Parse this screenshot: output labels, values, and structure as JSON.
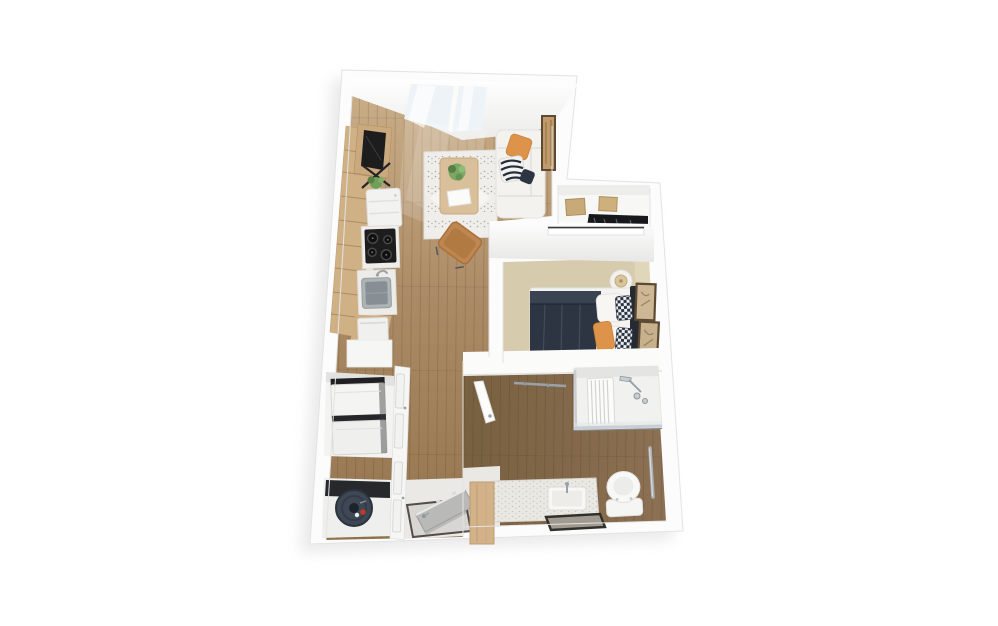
{
  "image": {
    "type": "3d-floor-plan-render",
    "description": "Top-down 3D rendering of a one-bedroom apartment floor plan with living room, galley kitchen, bedroom, bathroom, closets and entry, floating on a white background",
    "width": 998,
    "height": 626,
    "visible_text": ""
  },
  "palette": {
    "background": "#ffffff",
    "wall": "#fcfcfc",
    "wall_edge": "#e3e3e3",
    "shadow": "#d9d9d9",
    "wood_light": "#c9ad87",
    "wood_mid": "#ab8b66",
    "wood_dark": "#93744e",
    "bath_wood": "#77603f",
    "bath_wood_light": "#8d7154",
    "carpet": "#d7cbae",
    "rug": "#efeeea",
    "sofa": "#f3f2ef",
    "accent_orange": "#dd9349",
    "duvet_navy": "#2d3542",
    "leather": "#bf8651",
    "cabinet_wood": "#d0b186",
    "appliance_dark": "#1d1d1d",
    "steel": "#aeb4b6",
    "chrome": "#9aa2a8",
    "glass": "#eef3f7",
    "box_tan": "#c8aa78",
    "clothes_dark": "#16181c",
    "heater": "#3e4754",
    "heater_valve": "#c0392b",
    "frame_brown": "#5d4a33",
    "art_tan": "#c09a6b",
    "door_gray": "#b9b9b7",
    "entry_panel": "#d2b288"
  },
  "rooms": [
    {
      "name": "living-room",
      "floor": "hardwood",
      "furniture": [
        "window",
        "area-rug",
        "coffee-table",
        "potted-plant",
        "white-book",
        "sofa",
        "orange-throw-pillow",
        "zebra-throw-pillow",
        "accent-chair",
        "wall-art"
      ]
    },
    {
      "name": "kitchen",
      "floor": "hardwood",
      "furniture": [
        "wall-tv",
        "media-console",
        "plant",
        "refrigerator",
        "cooktop",
        "kitchen-sink",
        "wood-cabinets",
        "countertop",
        "dishwasher"
      ]
    },
    {
      "name": "hall-closet",
      "floor": "white",
      "furniture": [
        "storage-box",
        "storage-box",
        "hanging-clothes",
        "sliding-door"
      ]
    },
    {
      "name": "bedroom",
      "floor": "carpet",
      "furniture": [
        "bed",
        "navy-duvet",
        "white-pillows",
        "checkered-pillows",
        "orange-pillow",
        "headboard",
        "round-nightstand",
        "table-lamp",
        "leaning-picture-frames",
        "sliding-door"
      ]
    },
    {
      "name": "bathroom",
      "floor": "dark-hardwood",
      "furniture": [
        "walk-in-shower",
        "shower-bench",
        "shower-fixtures",
        "glass-partition",
        "toilet",
        "grab-bar",
        "vanity-counter",
        "vanity-sink",
        "leaning-mirror",
        "bathroom-door",
        "door-rail"
      ]
    },
    {
      "name": "laundry-closet",
      "floor": "white",
      "furniture": [
        "stacked-washer-dryer",
        "closet-doors"
      ]
    },
    {
      "name": "utility-closet",
      "floor": "white",
      "furniture": [
        "water-heater"
      ]
    },
    {
      "name": "entry",
      "floor": "white",
      "furniture": [
        "entry-door",
        "door-mat",
        "wood-side-panel"
      ]
    }
  ]
}
